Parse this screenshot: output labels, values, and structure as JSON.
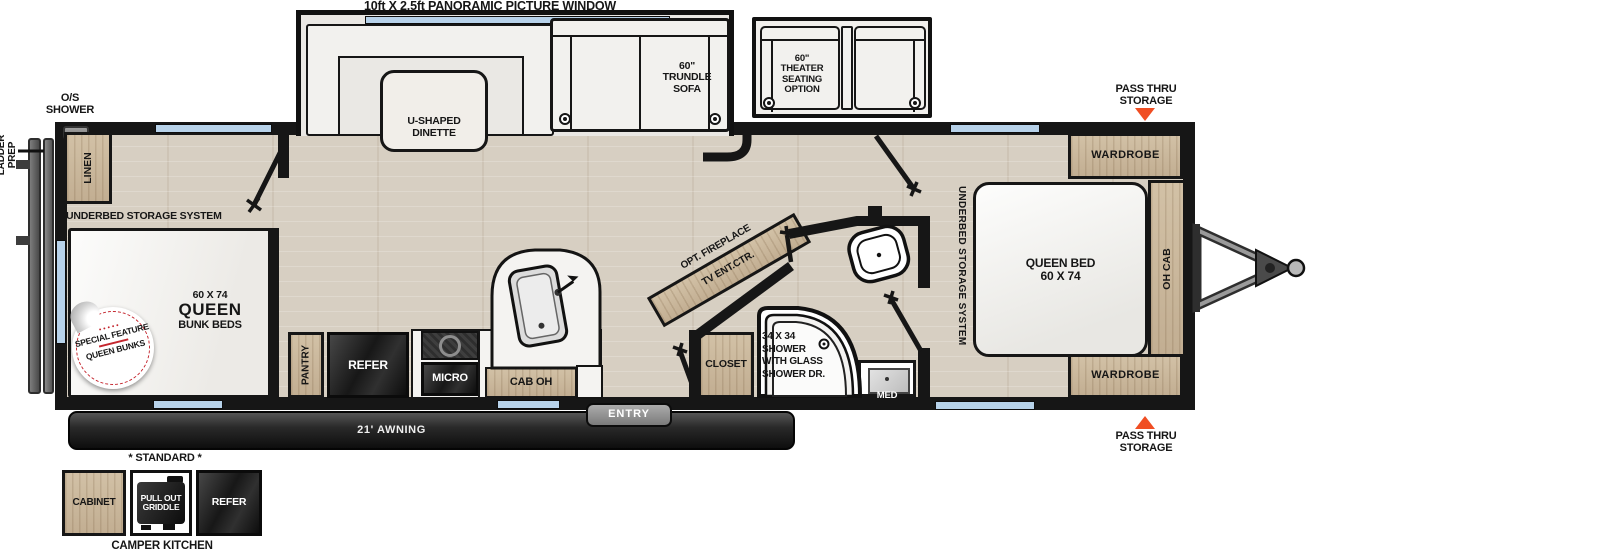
{
  "title": "10ft X 2.5ft PANORAMIC PICTURE WINDOW",
  "colors": {
    "accent_orange": "#f04e23",
    "window_blue": "#b7d2ea",
    "wall_black": "#161616",
    "floor_wood": "#d7cfc2",
    "cabinet_wood": "#cbb89c",
    "appliance_dark": "#1c1c1c",
    "badge_red": "#c4262e"
  },
  "exterior": {
    "os_shower": "O/S\nSHOWER",
    "ladder_prep": "LADDER\nPREP",
    "pass_thru": "PASS THRU\nSTORAGE",
    "awning": "21' AWNING",
    "entry": "ENTRY"
  },
  "front_bedroom": {
    "linen": "LINEN",
    "underbed": "UNDERBED STORAGE SYSTEM",
    "bunk_size": "60 X 74",
    "bunk_name": "QUEEN",
    "bunk_type": "BUNK BEDS",
    "badge_line1": "SPECIAL FEATURE",
    "badge_line2": "QUEEN BUNKS"
  },
  "living": {
    "dinette": "U-SHAPED\nDINETTE",
    "sofa": "60\"\nTRUNDLE\nSOFA",
    "theater": "60\"\nTHEATER\nSEATING\nOPTION",
    "fireplace": "OPT. FIREPLACE",
    "tv": "TV ENT.CTR."
  },
  "kitchen": {
    "pantry": "PANTRY",
    "refer": "REFER",
    "micro": "MICRO",
    "cab_oh": "CAB OH"
  },
  "bath": {
    "closet": "CLOSET",
    "shower": "34 X 34\nSHOWER\nWITH GLASS\nSHOWER DR.",
    "med": "MED"
  },
  "rear_bedroom": {
    "underbed": "UNDERBED STORAGE SYSTEM",
    "bed": "QUEEN BED\n60 X 74",
    "wardrobe": "WARDROBE",
    "oh_cab": "OH CAB"
  },
  "camper_kitchen": {
    "standard": "* STANDARD *",
    "cabinet": "CABINET",
    "griddle": "PULL OUT\nGRIDDLE",
    "refer": "REFER",
    "title": "CAMPER KITCHEN"
  }
}
